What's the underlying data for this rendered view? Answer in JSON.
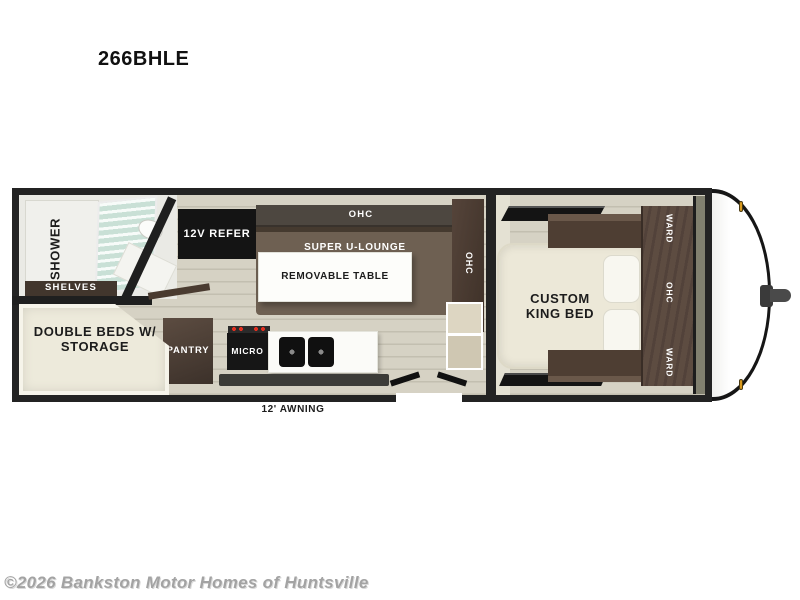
{
  "page": {
    "model": "266BHLE",
    "watermark": "©2026 Bankston Motor Homes of Huntsville"
  },
  "floorplan": {
    "awning_label": "12' AWNING",
    "bathroom": {
      "shower_label": "SHOWER",
      "shelves_label": "SHELVES"
    },
    "galley": {
      "refer_label": "12V REFER",
      "ohc_top_label": "OHC",
      "lounge_label": "SUPER U-LOUNGE",
      "table_label": "REMOVABLE TABLE",
      "lounge_ohc_label": "OHC",
      "pantry_label": "PANTRY",
      "micro_label": "MICRO"
    },
    "bunk_room": {
      "label_line1": "DOUBLE BEDS W/",
      "label_line2": "STORAGE"
    },
    "bedroom": {
      "bed_label_line1": "CUSTOM",
      "bed_label_line2": "KING BED",
      "ward_top_label": "WARD",
      "ohc_label": "OHC",
      "ward_bottom_label": "WARD"
    },
    "colors": {
      "wall": "#232323",
      "floor": "#d5d1c3",
      "cabinet_dark": "#4a3a30",
      "lounge_brown": "#6e6052",
      "upholstery_cream": "#ece8d8",
      "counter_white": "#fbfbf8",
      "appliance_black": "#141414",
      "shower_glass": "#cfe4da",
      "marker_light": "#d99a1e",
      "watermark_gray": "#a3a3a3"
    }
  }
}
